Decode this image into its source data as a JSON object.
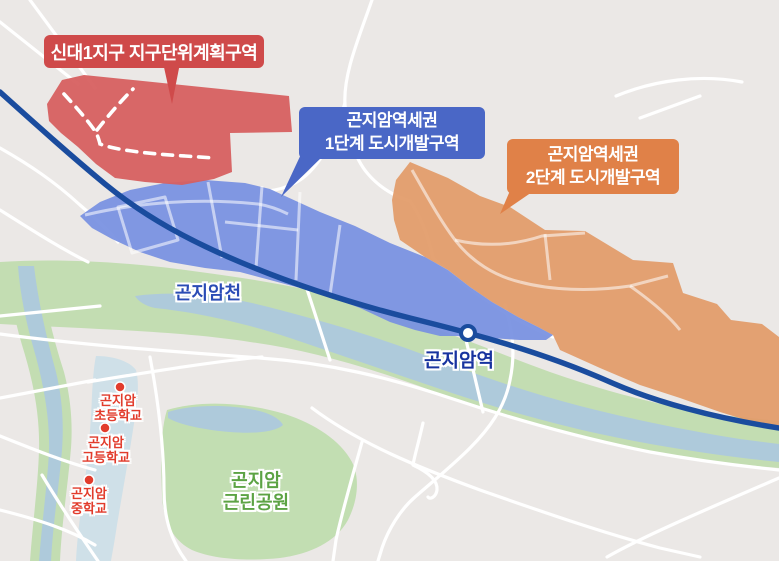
{
  "map": {
    "title": "곤지암역세권 도시개발구역 위치도",
    "callouts": {
      "sindae": {
        "text": "신대1지구 지구단위계획구역",
        "color": "#cf4a4a"
      },
      "phase1": {
        "line1": "곤지암역세권",
        "line2": "1단계 도시개발구역",
        "color": "#4a67c6"
      },
      "phase2": {
        "line1": "곤지암역세권",
        "line2": "2단계 도시개발구역",
        "color": "#e08148"
      }
    },
    "labels": {
      "river": "곤지암천",
      "station": "곤지암역",
      "park_line1": "곤지암",
      "park_line2": "근린공원",
      "school_elementary_line1": "곤지암",
      "school_elementary_line2": "초등학교",
      "school_high_line1": "곤지암",
      "school_high_line2": "고등학교",
      "school_middle_line1": "곤지암",
      "school_middle_line2": "중학교"
    },
    "colors": {
      "background": "#ebe8e6",
      "zone_sindae": "#d75f5f",
      "zone_phase1": "#7790e1",
      "zone_phase2": "#e29b68",
      "callout_sindae": "#cf4a4a",
      "callout_phase1": "#4a67c6",
      "callout_phase2": "#e08148",
      "railway": "#1a4c9e",
      "greenery": "#c3ddb2",
      "park": "#c2deb2",
      "water": "#aecadb",
      "school_campus": "#cfe0e8",
      "road": "#ffffff",
      "school_text": "#e23c2c",
      "park_text": "#5ca344",
      "water_text": "#2a4cb5",
      "station_text": "#17339f"
    }
  }
}
